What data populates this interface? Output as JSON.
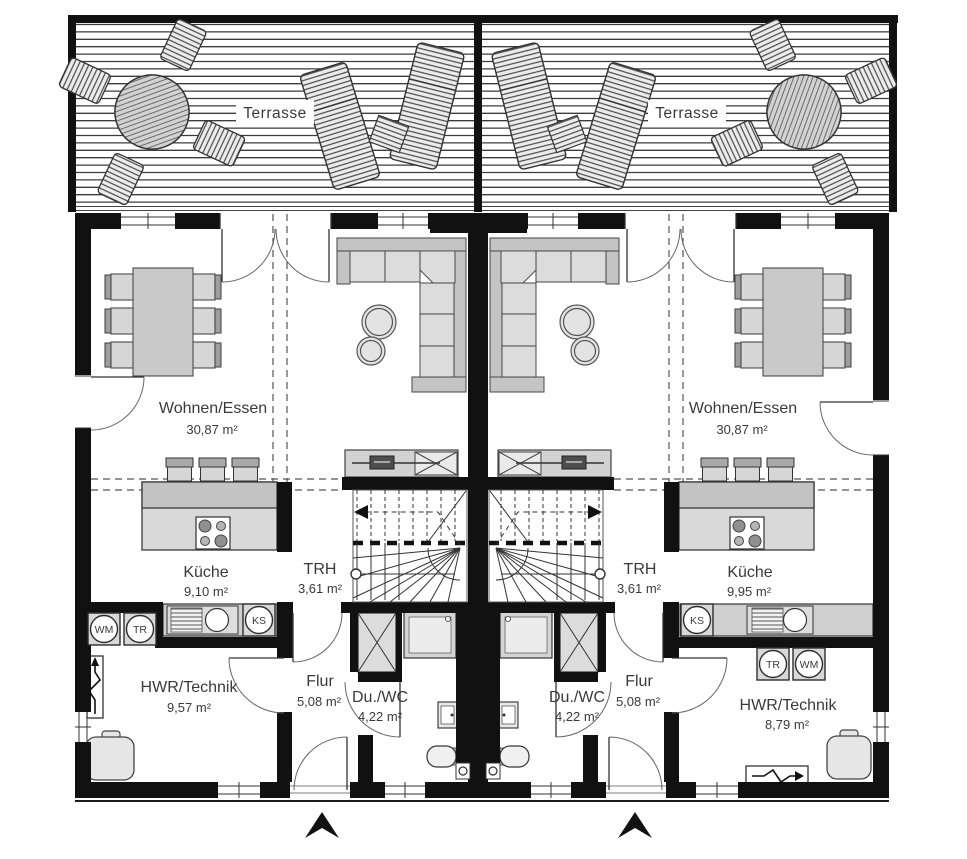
{
  "plan": {
    "type": "floorplan",
    "terrace": {
      "label": "Terrasse"
    },
    "palette": {
      "wall": "#111111",
      "furniture": "#d6d6d6",
      "text": "#3a3a3a",
      "floor": "#ffffff"
    },
    "units": {
      "left": {
        "rooms": {
          "wohnen_essen": {
            "name": "Wohnen/Essen",
            "area": "30,87 m²"
          },
          "kueche": {
            "name": "Küche",
            "area": "9,10 m²"
          },
          "trh": {
            "name": "TRH",
            "area": "3,61 m²"
          },
          "flur": {
            "name": "Flur",
            "area": "5,08 m²"
          },
          "du_wc": {
            "name": "Du./WC",
            "area": "4,22 m²"
          },
          "hwr_technik": {
            "name": "HWR/Technik",
            "area": "9,57 m²"
          }
        },
        "appliances": {
          "wm": "WM",
          "tr": "TR",
          "ks": "KS"
        }
      },
      "right": {
        "rooms": {
          "wohnen_essen": {
            "name": "Wohnen/Essen",
            "area": "30,87 m²"
          },
          "kueche": {
            "name": "Küche",
            "area": "9,95 m²"
          },
          "trh": {
            "name": "TRH",
            "area": "3,61 m²"
          },
          "flur": {
            "name": "Flur",
            "area": "5,08 m²"
          },
          "du_wc": {
            "name": "Du./WC",
            "area": "4,22 m²"
          },
          "hwr_technik": {
            "name": "HWR/Technik",
            "area": "8,79 m²"
          }
        },
        "appliances": {
          "wm": "WM",
          "tr": "TR",
          "ks": "KS"
        }
      }
    }
  }
}
